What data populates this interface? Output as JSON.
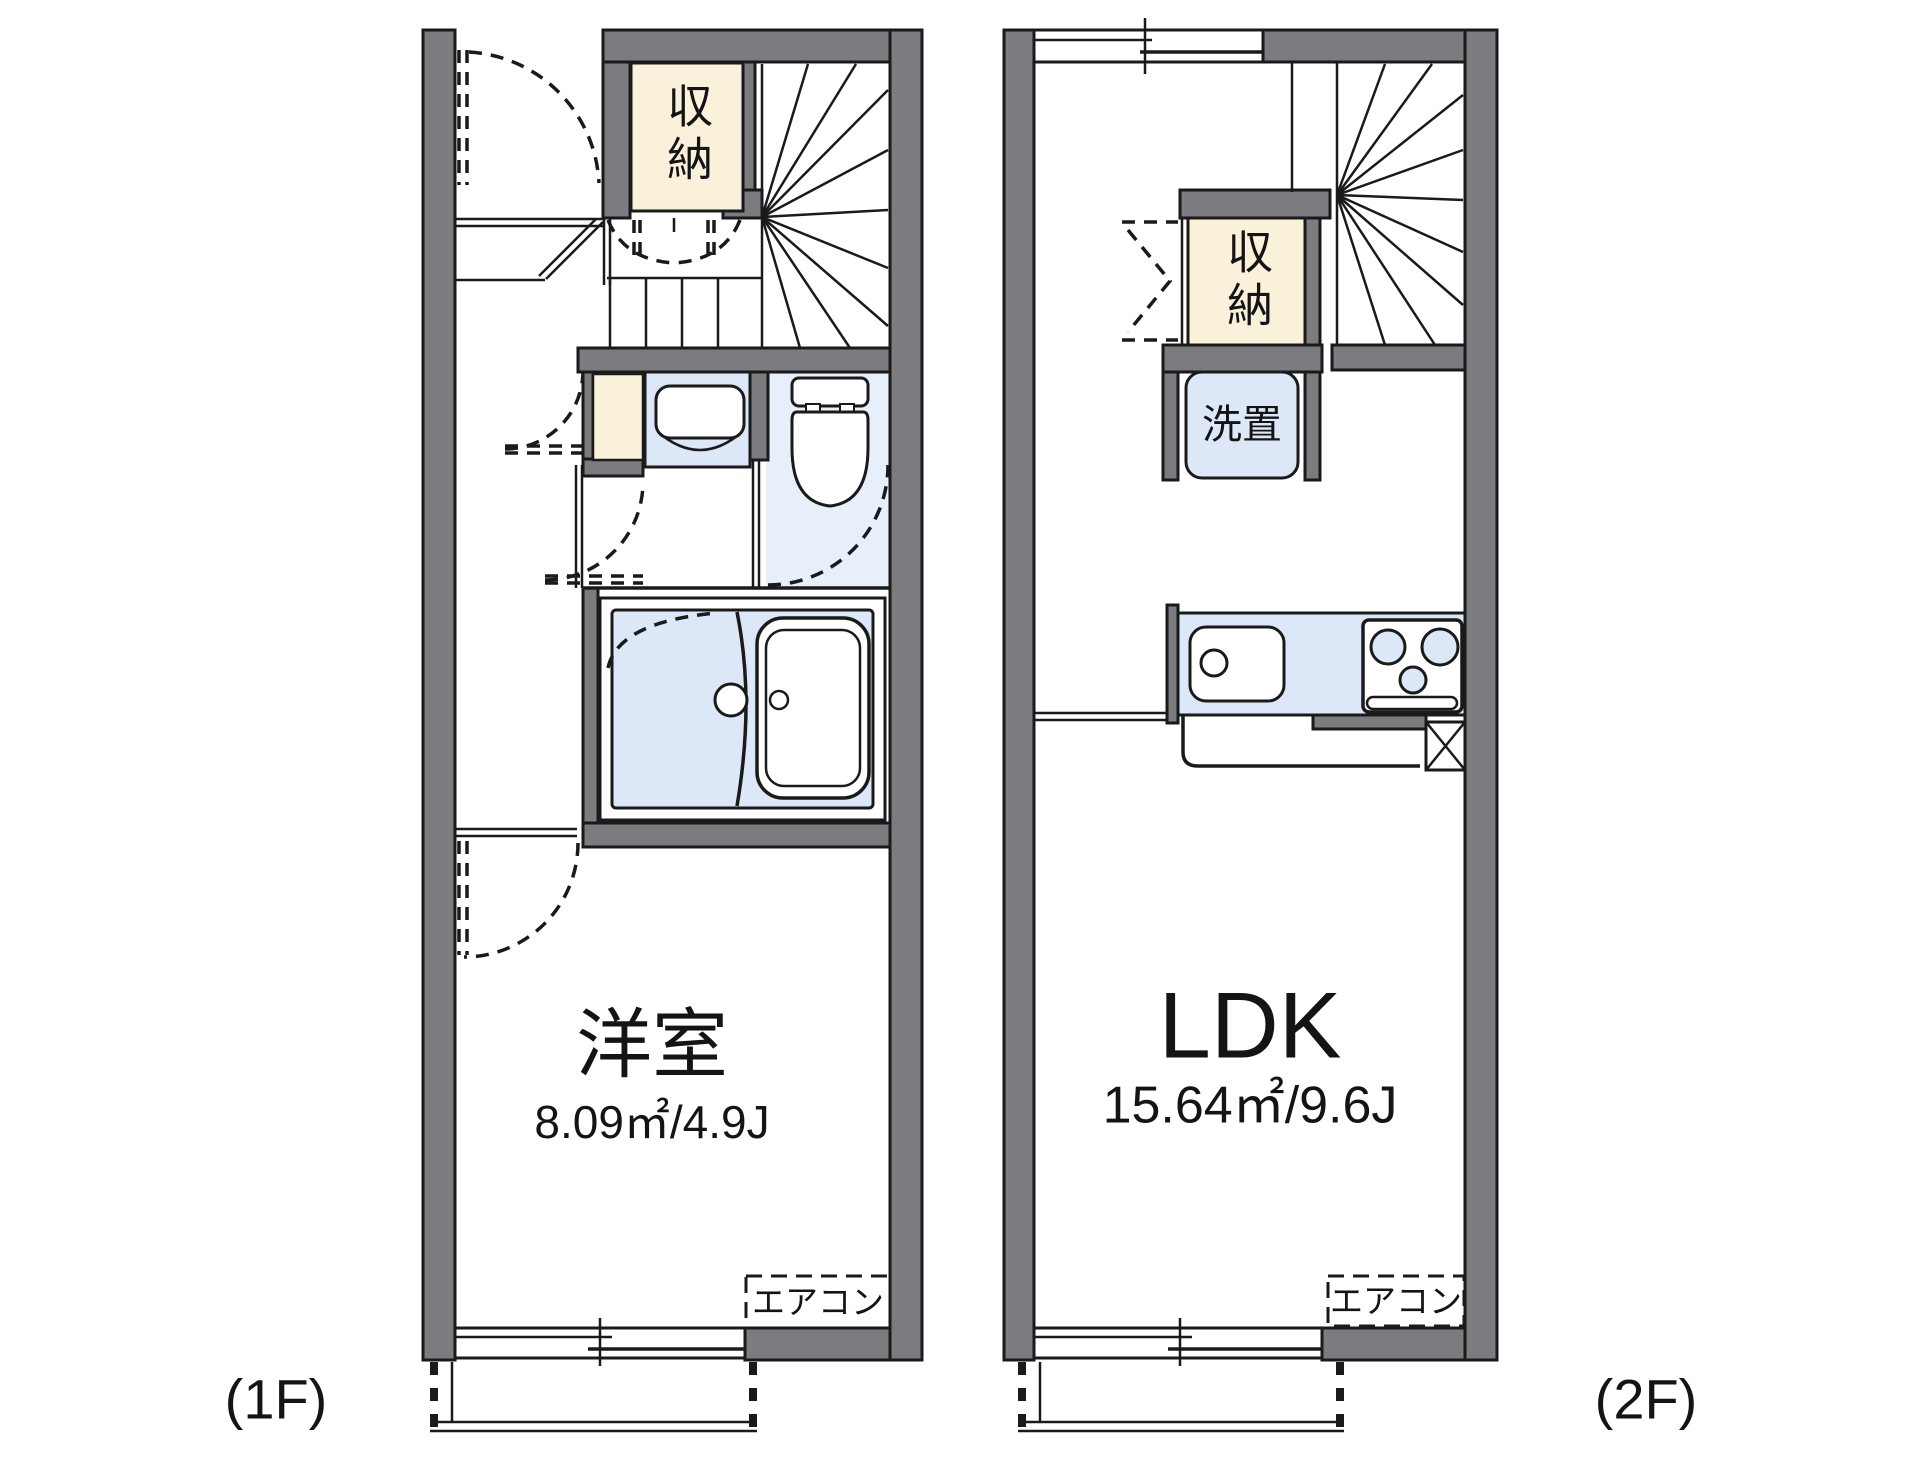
{
  "colors": {
    "bg": "#ffffff",
    "wall": "#7b7b80",
    "line": "#1a1a1a",
    "cream": "#faf1da",
    "fixture_blue": "#dce8f8",
    "room_blue": "#e7effb"
  },
  "floor1": {
    "floor_label": "(1F)",
    "closet_label": "収納",
    "room_label": "洋室",
    "room_area": "8.09㎡/4.9J",
    "aircon_label": "エアコン"
  },
  "floor2": {
    "floor_label": "(2F)",
    "closet_label": "収納",
    "laundry_label": "洗置",
    "room_label": "LDK",
    "room_area": "15.64㎡/9.6J",
    "aircon_label": "エアコン"
  }
}
